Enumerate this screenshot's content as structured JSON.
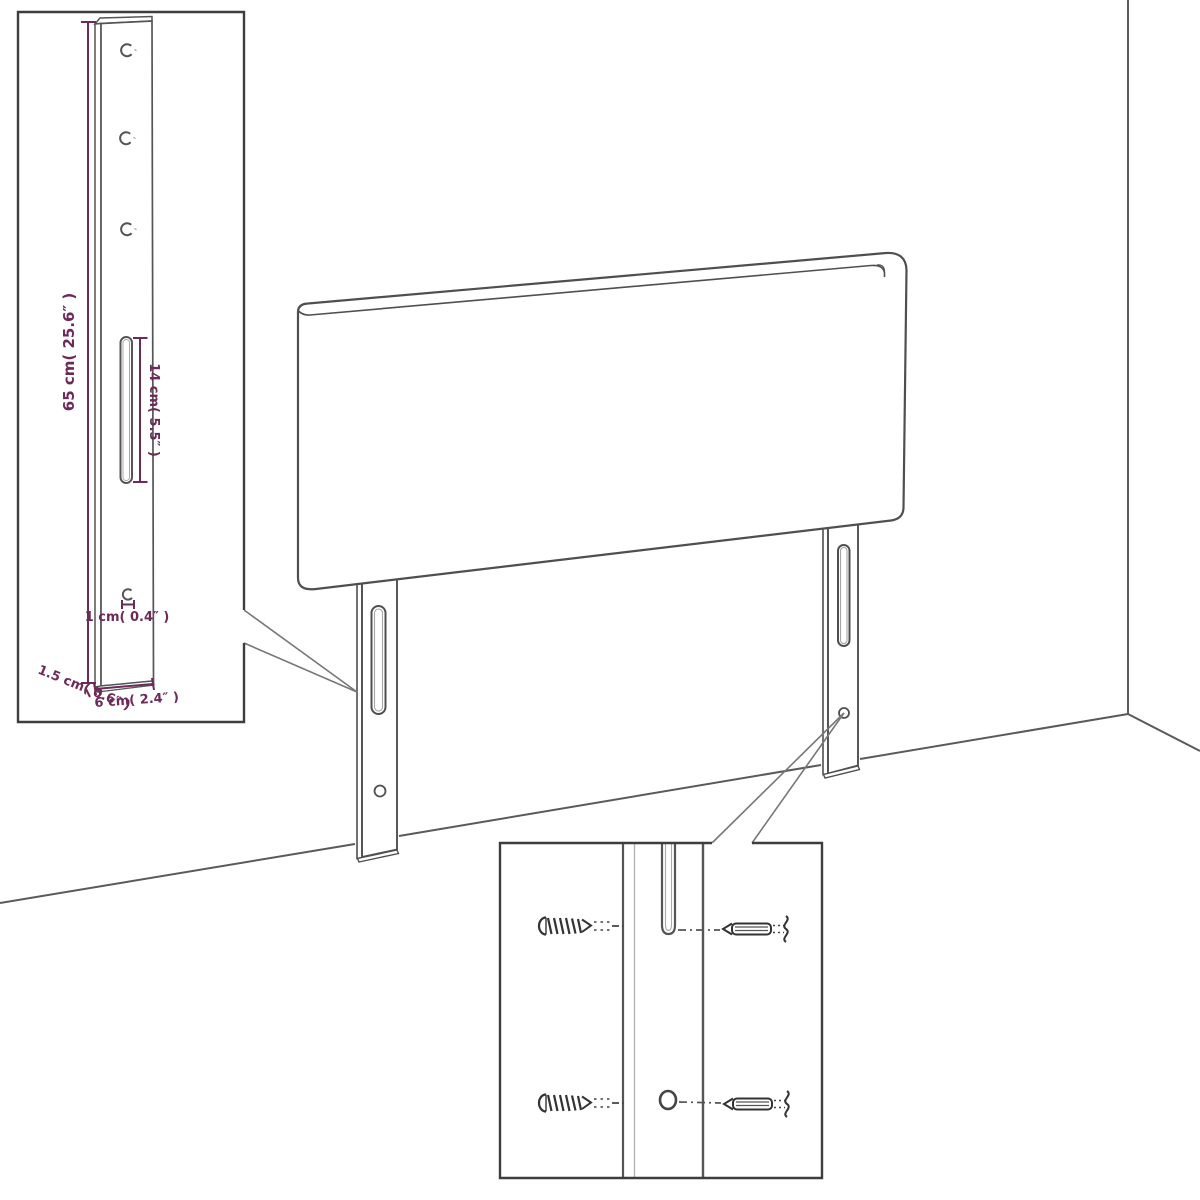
{
  "colors": {
    "line": "#4f4f4f",
    "light_line": "#a5a5a5",
    "dimension_accent": "#6d2a58",
    "inset_border": "#3d3d3d",
    "background": "#ffffff"
  },
  "insets": {
    "leg_detail": {
      "dimensions": {
        "height_label": "65 cm( 25.6″ )",
        "slot_label": "14 cm( 5.5″ )",
        "hole_offset_label": "1 cm( 0.4″ )",
        "thickness_label": "1.5 cm( 0.6″ )",
        "width_label": "6 cm( 2.4″ )"
      }
    },
    "mounting_detail": {
      "icons": [
        "screw-icon",
        "screw-icon",
        "wall-plug-icon",
        "wall-plug-icon"
      ]
    }
  }
}
